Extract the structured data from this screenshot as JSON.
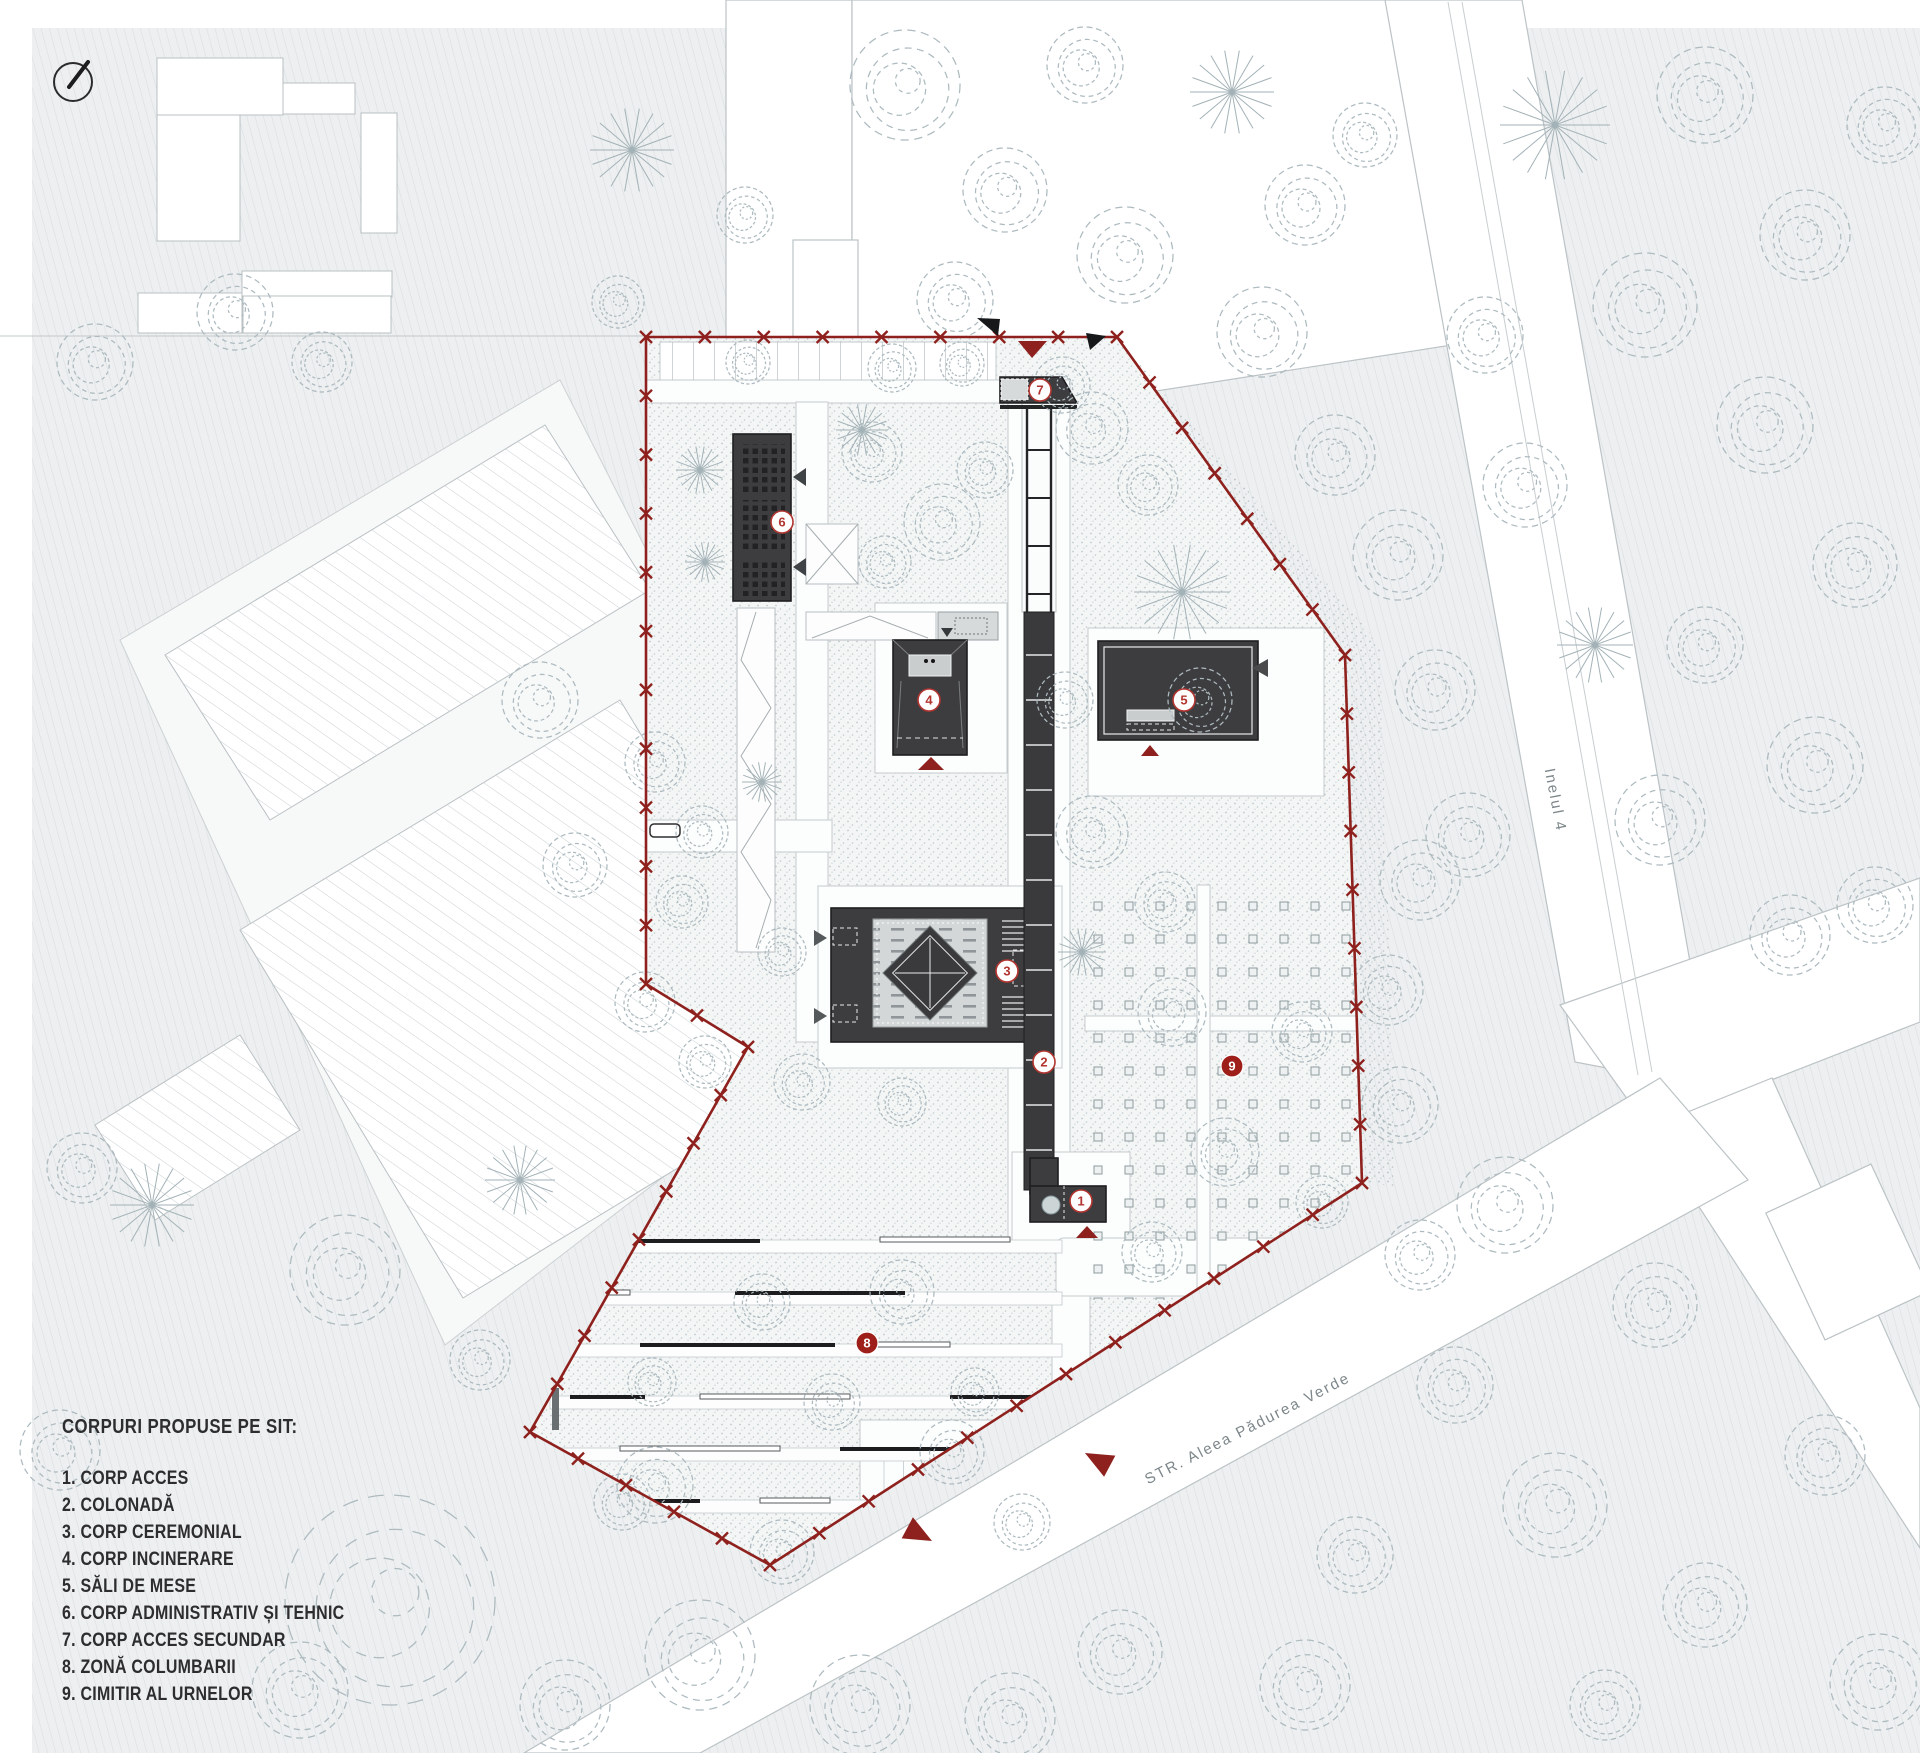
{
  "legend": {
    "title": "CORPURI PROPUSE PE SIT:",
    "items": [
      "1. CORP ACCES",
      "2. COLONADĂ",
      "3. CORP CEREMONIAL",
      "4. CORP INCINERARE",
      "5. SĂLI DE MESE",
      "6. CORP ADMINISTRATIV ȘI TEHNIC",
      "7. CORP ACCES SECUNDAR",
      "8. ZONĂ COLUMBARII",
      "9. CIMITIR AL URNELOR"
    ]
  },
  "road_labels": {
    "ring": "Inelul 4",
    "street": "STR. Aleea Pădurea Verde"
  },
  "markers": [
    {
      "num": "1",
      "type": "building"
    },
    {
      "num": "2",
      "type": "building"
    },
    {
      "num": "3",
      "type": "building"
    },
    {
      "num": "4",
      "type": "building"
    },
    {
      "num": "5",
      "type": "building"
    },
    {
      "num": "6",
      "type": "building"
    },
    {
      "num": "7",
      "type": "building"
    },
    {
      "num": "8",
      "type": "area"
    },
    {
      "num": "9",
      "type": "area"
    }
  ],
  "colors": {
    "boundary_red": "#8e211d",
    "marker_red": "#b23530",
    "building_dark": "#3d3d3f",
    "background": "#eef0f1",
    "tree_stroke": "#adbabf"
  },
  "plan": {
    "boundary": [
      [
        646,
        337
      ],
      [
        1117,
        337
      ],
      [
        1345,
        655
      ],
      [
        1362,
        1183
      ],
      [
        770,
        1565
      ],
      [
        530,
        1432
      ],
      [
        748,
        1047
      ],
      [
        646,
        984
      ]
    ],
    "trees": [
      [
        905,
        85,
        55,
        0
      ],
      [
        1005,
        190,
        42,
        0
      ],
      [
        955,
        300,
        38,
        0
      ],
      [
        1085,
        65,
        38,
        0
      ],
      [
        1125,
        255,
        48,
        0
      ],
      [
        1062,
        385,
        28,
        0
      ],
      [
        632,
        150,
        42,
        1
      ],
      [
        745,
        215,
        28,
        0
      ],
      [
        1232,
        92,
        42,
        1
      ],
      [
        1305,
        205,
        40,
        0
      ],
      [
        1262,
        332,
        45,
        0
      ],
      [
        1365,
        135,
        32,
        0
      ],
      [
        1335,
        455,
        40,
        0
      ],
      [
        1398,
        555,
        45,
        0
      ],
      [
        1435,
        690,
        40,
        0
      ],
      [
        1182,
        592,
        48,
        1
      ],
      [
        1200,
        700,
        32,
        0
      ],
      [
        1148,
        485,
        30,
        0
      ],
      [
        1420,
        880,
        40,
        0
      ],
      [
        1388,
        990,
        35,
        0
      ],
      [
        1400,
        1105,
        38,
        0
      ],
      [
        1555,
        125,
        55,
        1
      ],
      [
        1705,
        95,
        48,
        0
      ],
      [
        1805,
        235,
        45,
        0
      ],
      [
        1645,
        305,
        52,
        0
      ],
      [
        1765,
        425,
        48,
        0
      ],
      [
        1855,
        565,
        42,
        0
      ],
      [
        1705,
        645,
        38,
        0
      ],
      [
        1815,
        765,
        48,
        0
      ],
      [
        1885,
        125,
        38,
        0
      ],
      [
        1485,
        335,
        38,
        0
      ],
      [
        1525,
        485,
        42,
        0
      ],
      [
        1595,
        645,
        38,
        1
      ],
      [
        1875,
        905,
        38,
        0
      ],
      [
        1468,
        835,
        42,
        0
      ],
      [
        1660,
        820,
        45,
        0
      ],
      [
        1790,
        935,
        40,
        0
      ],
      [
        1505,
        1205,
        48,
        0
      ],
      [
        1655,
        1305,
        42,
        0
      ],
      [
        1455,
        1385,
        38,
        0
      ],
      [
        1555,
        1505,
        52,
        0
      ],
      [
        1705,
        1605,
        42,
        0
      ],
      [
        1355,
        1555,
        38,
        0
      ],
      [
        1305,
        1685,
        45,
        0
      ],
      [
        1605,
        1705,
        35,
        0
      ],
      [
        1825,
        1455,
        40,
        0
      ],
      [
        1878,
        1682,
        48,
        0
      ],
      [
        1420,
        1255,
        35,
        0
      ],
      [
        390,
        1600,
        105,
        0
      ],
      [
        300,
        1690,
        48,
        0
      ],
      [
        565,
        1705,
        45,
        0
      ],
      [
        655,
        1485,
        38,
        0
      ],
      [
        700,
        1655,
        55,
        0
      ],
      [
        860,
        1705,
        50,
        0
      ],
      [
        1010,
        1718,
        45,
        0
      ],
      [
        1120,
        1652,
        42,
        0
      ],
      [
        480,
        1360,
        30,
        0
      ],
      [
        60,
        1450,
        40,
        0
      ],
      [
        235,
        312,
        38,
        0
      ],
      [
        322,
        362,
        30,
        0
      ],
      [
        95,
        362,
        38,
        0
      ],
      [
        152,
        1205,
        42,
        1
      ],
      [
        82,
        1168,
        35,
        0
      ],
      [
        345,
        1270,
        55,
        0
      ],
      [
        540,
        700,
        38,
        0
      ],
      [
        575,
        865,
        32,
        0
      ],
      [
        618,
        302,
        26,
        0
      ],
      [
        520,
        1180,
        35,
        1
      ],
      [
        748,
        362,
        22,
        0
      ],
      [
        892,
        368,
        24,
        0
      ],
      [
        962,
        364,
        22,
        0
      ],
      [
        1092,
        428,
        36,
        0
      ],
      [
        872,
        452,
        30,
        0
      ],
      [
        942,
        522,
        38,
        0
      ],
      [
        885,
        562,
        26,
        0
      ],
      [
        862,
        430,
        26,
        1
      ],
      [
        700,
        470,
        24,
        1
      ],
      [
        705,
        562,
        20,
        1
      ],
      [
        655,
        762,
        30,
        0
      ],
      [
        702,
        832,
        26,
        0
      ],
      [
        762,
        782,
        20,
        1
      ],
      [
        682,
        902,
        26,
        0
      ],
      [
        645,
        1002,
        30,
        0
      ],
      [
        705,
        1062,
        26,
        0
      ],
      [
        1092,
        832,
        36,
        0
      ],
      [
        1165,
        902,
        30,
        0
      ],
      [
        1082,
        952,
        24,
        1
      ],
      [
        782,
        952,
        24,
        0
      ],
      [
        802,
        1082,
        28,
        0
      ],
      [
        902,
        1102,
        24,
        0
      ],
      [
        1172,
        1012,
        34,
        0
      ],
      [
        1302,
        1032,
        30,
        0
      ],
      [
        1225,
        1152,
        34,
        0
      ],
      [
        1152,
        1252,
        30,
        0
      ],
      [
        1322,
        1202,
        26,
        0
      ],
      [
        762,
        1302,
        28,
        0
      ],
      [
        902,
        1292,
        32,
        0
      ],
      [
        832,
        1402,
        28,
        0
      ],
      [
        952,
        1452,
        32,
        0
      ],
      [
        652,
        1382,
        24,
        0
      ],
      [
        622,
        1502,
        28,
        0
      ],
      [
        782,
        1552,
        32,
        0
      ],
      [
        1022,
        1522,
        28,
        0
      ],
      [
        975,
        1392,
        24,
        0
      ],
      [
        1065,
        700,
        28,
        0
      ],
      [
        985,
        470,
        28,
        0
      ]
    ]
  }
}
